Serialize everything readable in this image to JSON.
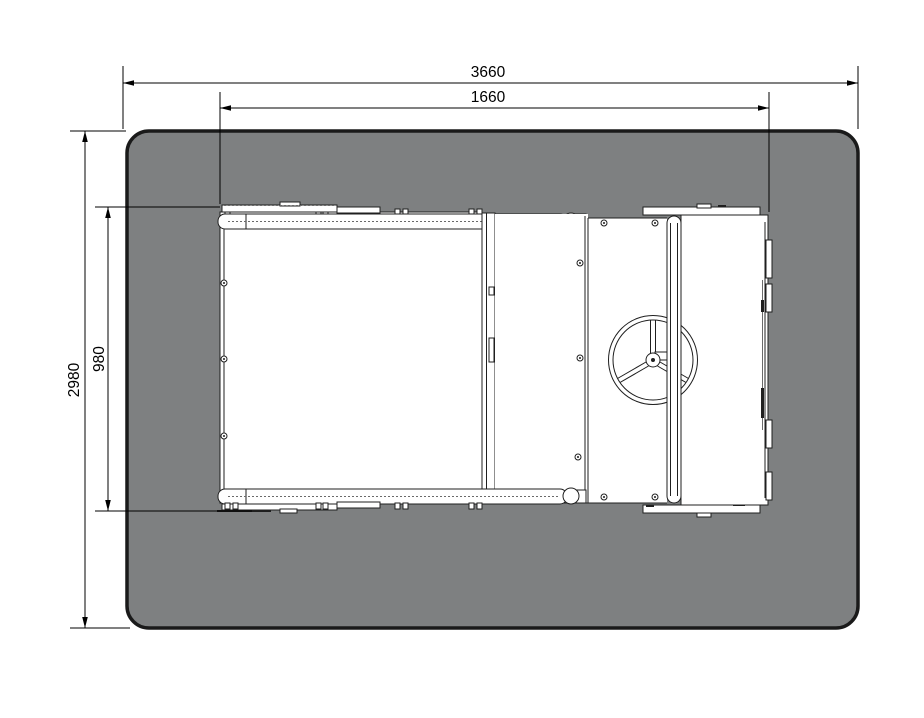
{
  "diagram": {
    "kind": "equipment-plan-top-view",
    "dimensions": {
      "overall_width": "3660",
      "equipment_width": "1660",
      "overall_depth": "2980",
      "equipment_depth": "980"
    }
  },
  "colors": {
    "zone_fill": "#7e8081",
    "zone_border": "#1a1a1a",
    "line": "#1f1f1f",
    "detail_line": "#6a6a6a",
    "dim_line": "#000000"
  }
}
